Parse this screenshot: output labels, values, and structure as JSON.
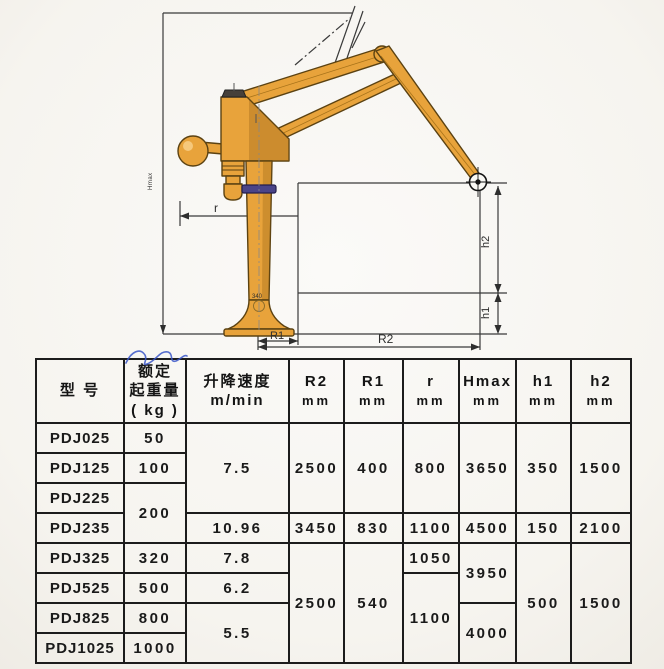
{
  "diagram": {
    "labels": {
      "r": "r",
      "r1": "R1",
      "r2": "R2",
      "h1": "h1",
      "h2": "h2",
      "hmax": "Hmax",
      "base_mark": "340"
    },
    "colors": {
      "crane_body": "#E8A33B",
      "crane_shadow": "#C9831E",
      "crane_outline": "#5B4212",
      "collar_band": "#4A4488",
      "dimension_line": "#3A3A3A",
      "table_line": "#1C1C1C",
      "ink": "#141414",
      "handwriting_blue": "#3A56C8",
      "paper": "#F7F5F1"
    }
  },
  "table": {
    "headers": [
      {
        "id": "model",
        "lines": [
          "型 号"
        ]
      },
      {
        "id": "load",
        "lines": [
          "额定",
          "起重量",
          "( kg )"
        ]
      },
      {
        "id": "speed",
        "lines": [
          "升降速度",
          "m/min"
        ]
      },
      {
        "id": "r2",
        "lines": [
          "R2",
          "mm"
        ]
      },
      {
        "id": "r1",
        "lines": [
          "R1",
          "mm"
        ]
      },
      {
        "id": "r",
        "lines": [
          "r",
          "mm"
        ]
      },
      {
        "id": "hmax",
        "lines": [
          "Hmax",
          "mm"
        ]
      },
      {
        "id": "h1",
        "lines": [
          "h1",
          "mm"
        ]
      },
      {
        "id": "h2",
        "lines": [
          "h2",
          "mm"
        ]
      }
    ],
    "rows": [
      {
        "cells": [
          {
            "t": "PDJ025",
            "n": "model-cell",
            "cls": "model"
          },
          {
            "t": "50"
          },
          {
            "t": "7.5",
            "rs": 3
          },
          {
            "t": "2500",
            "rs": 3
          },
          {
            "t": "400",
            "rs": 3
          },
          {
            "t": "800",
            "rs": 3
          },
          {
            "t": "3650",
            "rs": 3
          },
          {
            "t": "350",
            "rs": 3
          },
          {
            "t": "1500",
            "rs": 3
          }
        ]
      },
      {
        "cells": [
          {
            "t": "PDJ125",
            "n": "model-cell",
            "cls": "model"
          },
          {
            "t": "100"
          }
        ]
      },
      {
        "cells": [
          {
            "t": "PDJ225",
            "n": "model-cell",
            "cls": "model"
          },
          {
            "t": "200",
            "rs": 2
          }
        ]
      },
      {
        "cells": [
          {
            "t": "PDJ235",
            "n": "model-cell",
            "cls": "model"
          },
          {
            "t": "10.96"
          },
          {
            "t": "3450"
          },
          {
            "t": "830"
          },
          {
            "t": "1100"
          },
          {
            "t": "4500"
          },
          {
            "t": "150"
          },
          {
            "t": "2100"
          }
        ]
      },
      {
        "cells": [
          {
            "t": "PDJ325",
            "n": "model-cell",
            "cls": "model"
          },
          {
            "t": "320"
          },
          {
            "t": "7.8"
          },
          {
            "t": "2500",
            "rs": 4
          },
          {
            "t": "540",
            "rs": 4
          },
          {
            "t": "1050"
          },
          {
            "t": "3950",
            "rs": 2
          },
          {
            "t": "500",
            "rs": 4
          },
          {
            "t": "1500",
            "rs": 4
          }
        ]
      },
      {
        "cells": [
          {
            "t": "PDJ525",
            "n": "model-cell",
            "cls": "model"
          },
          {
            "t": "500"
          },
          {
            "t": "6.2"
          },
          {
            "t": "1100",
            "rs": 3
          }
        ]
      },
      {
        "cells": [
          {
            "t": "PDJ825",
            "n": "model-cell",
            "cls": "model"
          },
          {
            "t": "800"
          },
          {
            "t": "5.5",
            "rs": 2
          },
          {
            "t": "4000",
            "rs": 2
          }
        ]
      },
      {
        "cells": [
          {
            "t": "PDJ1025",
            "n": "model-cell",
            "cls": "model"
          },
          {
            "t": "1000"
          }
        ]
      }
    ]
  }
}
